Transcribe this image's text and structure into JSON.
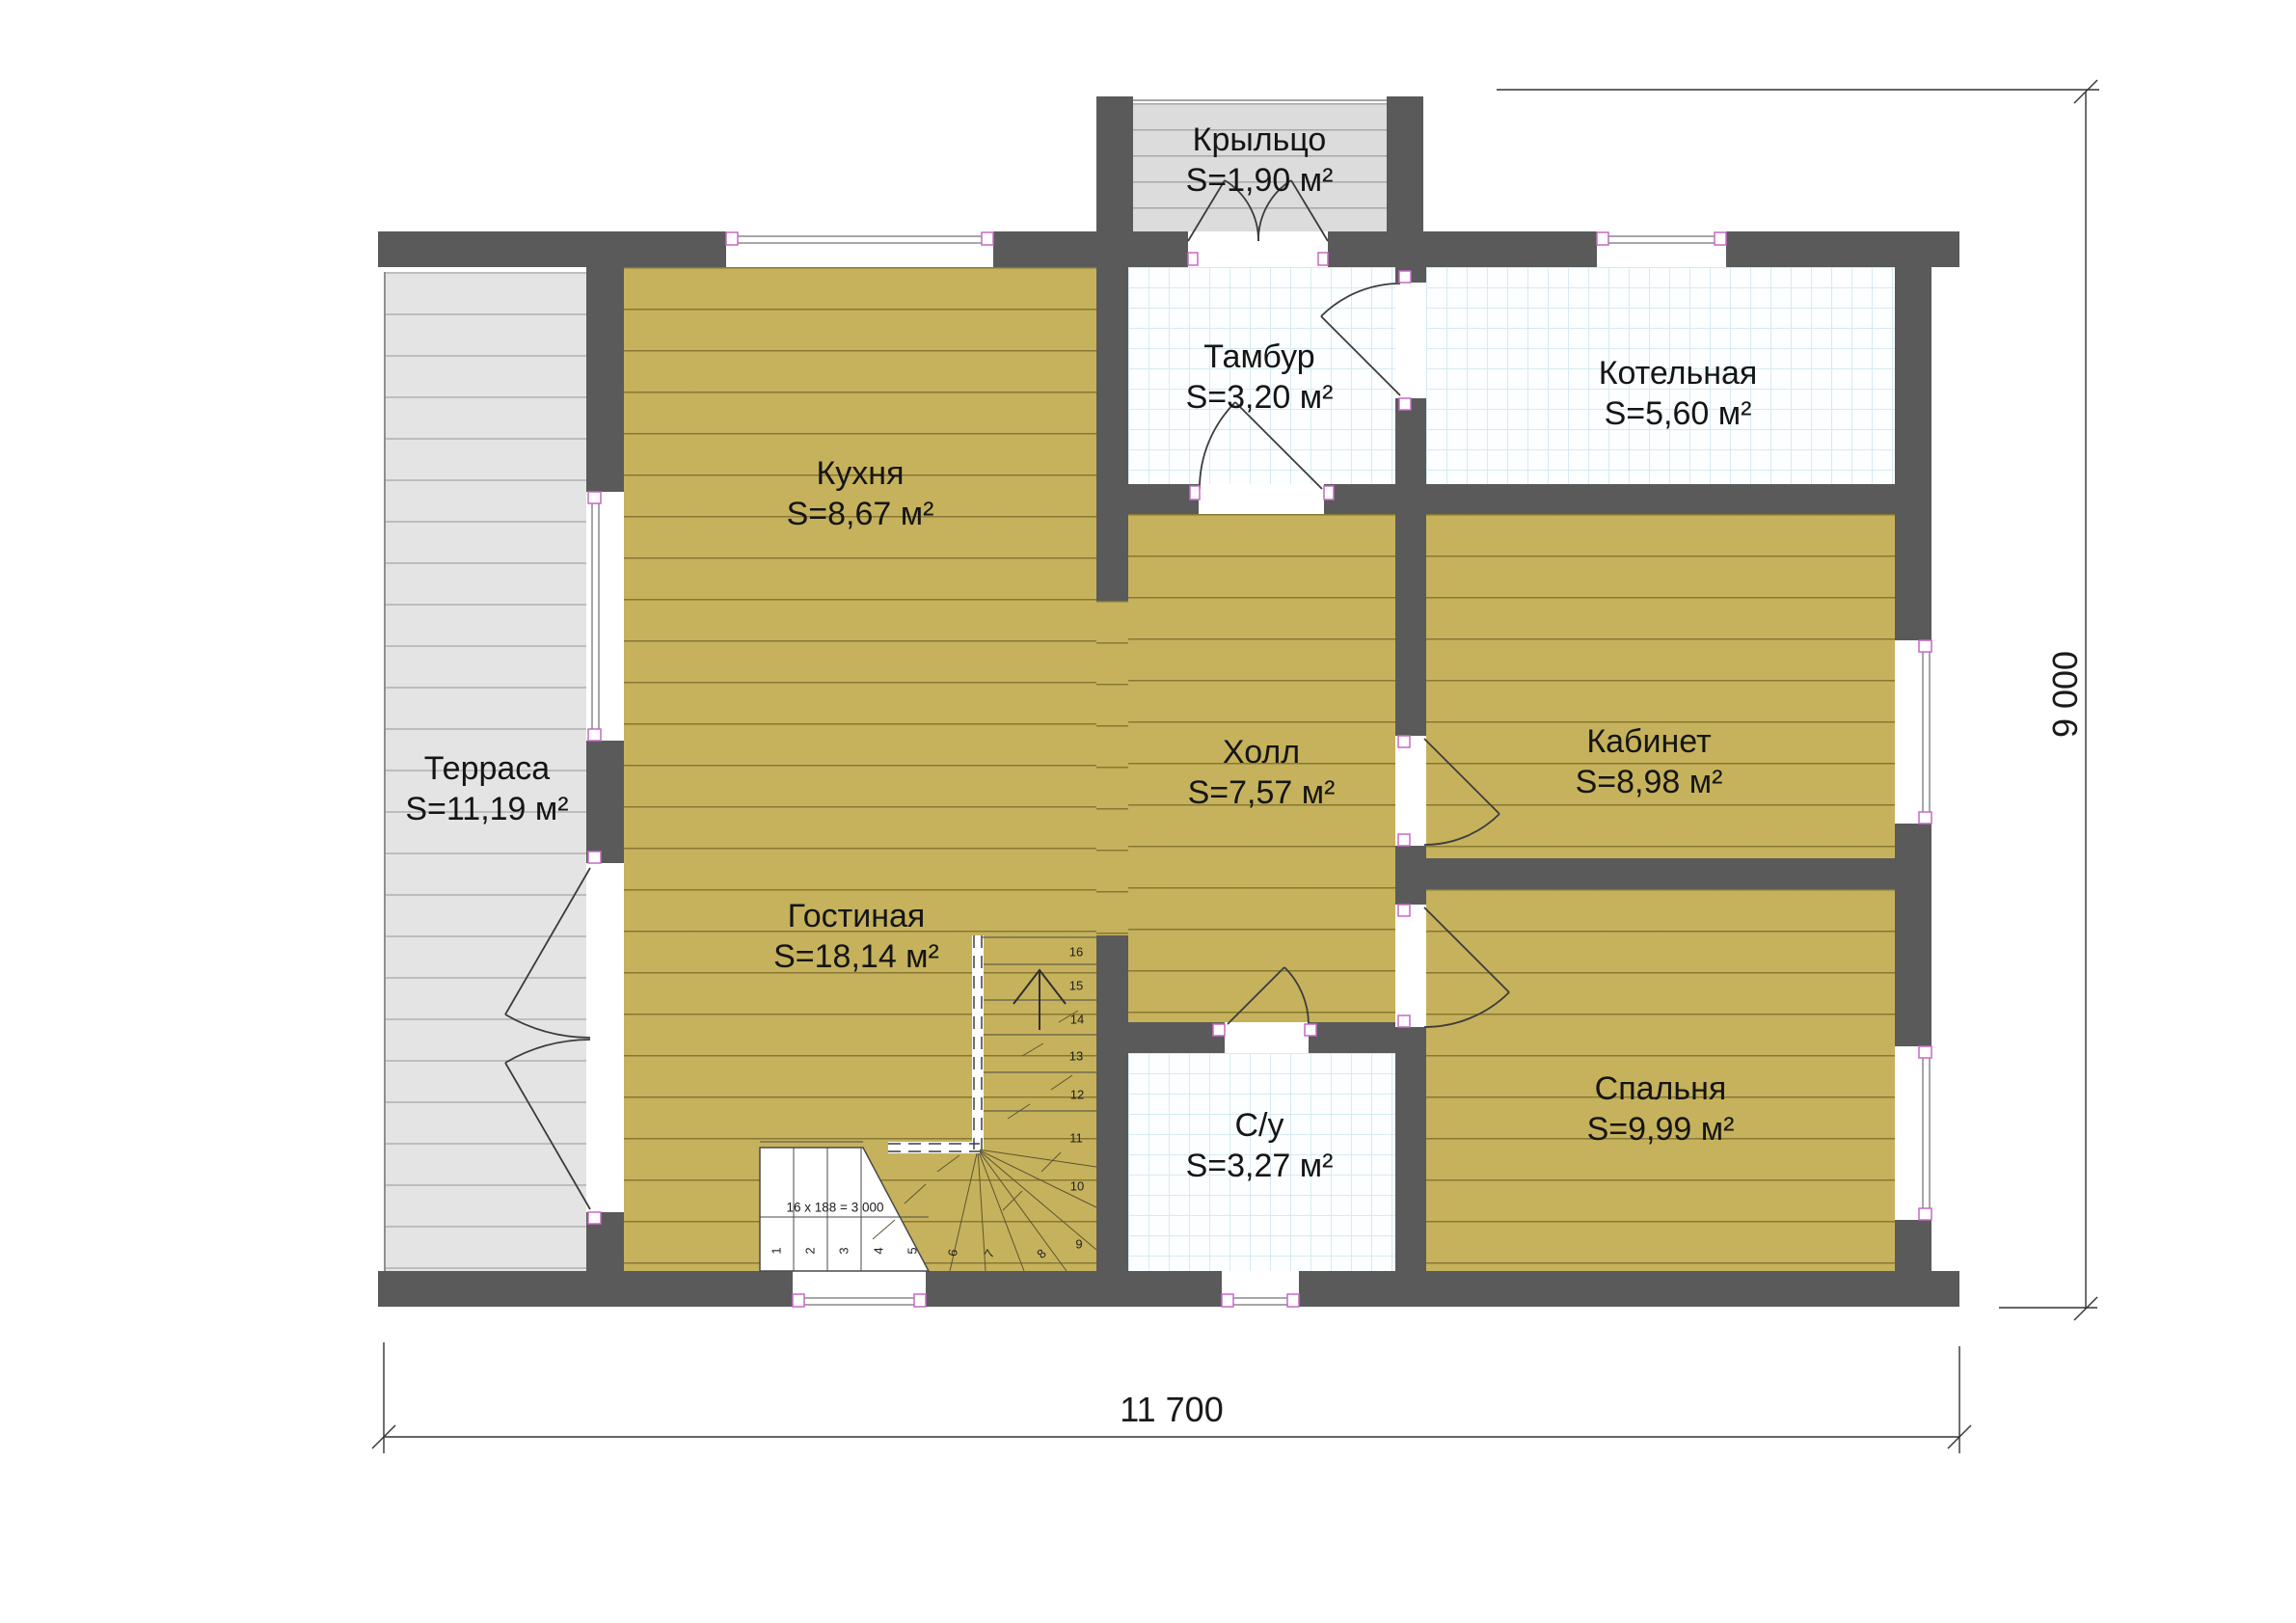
{
  "plan_type": "floor-plan",
  "rooms": [
    {
      "id": "kitchen",
      "name": "Кухня",
      "area": "S=8,67 м²"
    },
    {
      "id": "terrace",
      "name": "Терраса",
      "area": "S=11,19 м²"
    },
    {
      "id": "living",
      "name": "Гостиная",
      "area": "S=18,14 м²"
    },
    {
      "id": "porch",
      "name": "Крыльцо",
      "area": "S=1,90 м²"
    },
    {
      "id": "vestibule",
      "name": "Тамбур",
      "area": "S=3,20 м²"
    },
    {
      "id": "boiler",
      "name": "Котельная",
      "area": "S=5,60 м²"
    },
    {
      "id": "hall",
      "name": "Холл",
      "area": "S=7,57 м²"
    },
    {
      "id": "office",
      "name": "Кабинет",
      "area": "S=8,98 м²"
    },
    {
      "id": "bedroom",
      "name": "Спальня",
      "area": "S=9,99 м²"
    },
    {
      "id": "bathroom",
      "name": "С/у",
      "area": "S=3,27 м²"
    }
  ],
  "dimensions": {
    "width_label": "11 700",
    "height_label": "9 000"
  },
  "stairs": {
    "annotation": "16 x 188 = 3 000",
    "treads": [
      "1",
      "2",
      "3",
      "4",
      "5",
      "6",
      "7",
      "8",
      "9",
      "10",
      "11",
      "12",
      "13",
      "14",
      "15",
      "16"
    ]
  },
  "colors": {
    "wall": "#5a5a5a",
    "wood_floor": "#c6b25c",
    "terrace_floor": "#e4e4e4",
    "porch_floor": "#dcdcdc",
    "tile_grid": "#d7ebf2",
    "window_mark": "#c668c6",
    "line": "#3c3c3c"
  }
}
